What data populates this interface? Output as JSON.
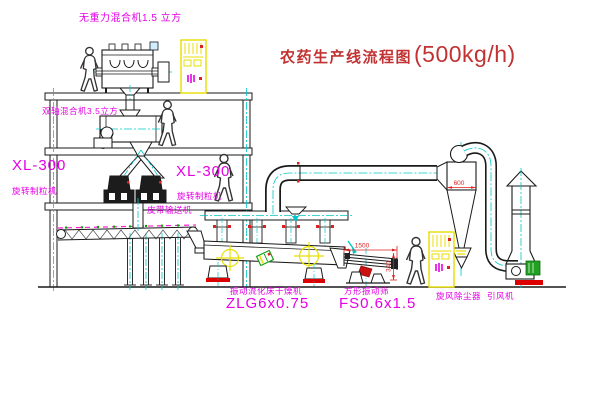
{
  "title": {
    "name": "农药生产线流程图",
    "capacity": "(500kg/h)"
  },
  "equipment_labels": {
    "gravity_free_mixer": "无重力混合机1.5 立方",
    "twin_shaft_mixer": "双轴混合机3.5立方",
    "granulator_left_model": "XL-300",
    "granulator_left_name": "旋转制粒机",
    "granulator_right_model": "XL-300",
    "granulator_right_name": "旋转制粒机",
    "belt_conveyor": "皮带输送机",
    "fluid_bed_dryer_name": "振动流化床干燥机",
    "fluid_bed_dryer_model": "ZLG6x0.75",
    "vibrating_screen_name": "方形振动筛",
    "vibrating_screen_model": "FS0.6x1.5",
    "cyclone": "旋风除尘器",
    "induced_draft_fan": "引风机"
  },
  "dimensions": {
    "screen_length": "1500",
    "screen_height": "340",
    "cyclone_diameter": "600"
  },
  "colors": {
    "label_magenta": "#e500e5",
    "title_red": "#c23232",
    "centerline_cyan": "#00c8c8",
    "cabinet_yellow": "#e8df00",
    "dimension_red": "#dd2222",
    "motor_green": "#22a022"
  }
}
